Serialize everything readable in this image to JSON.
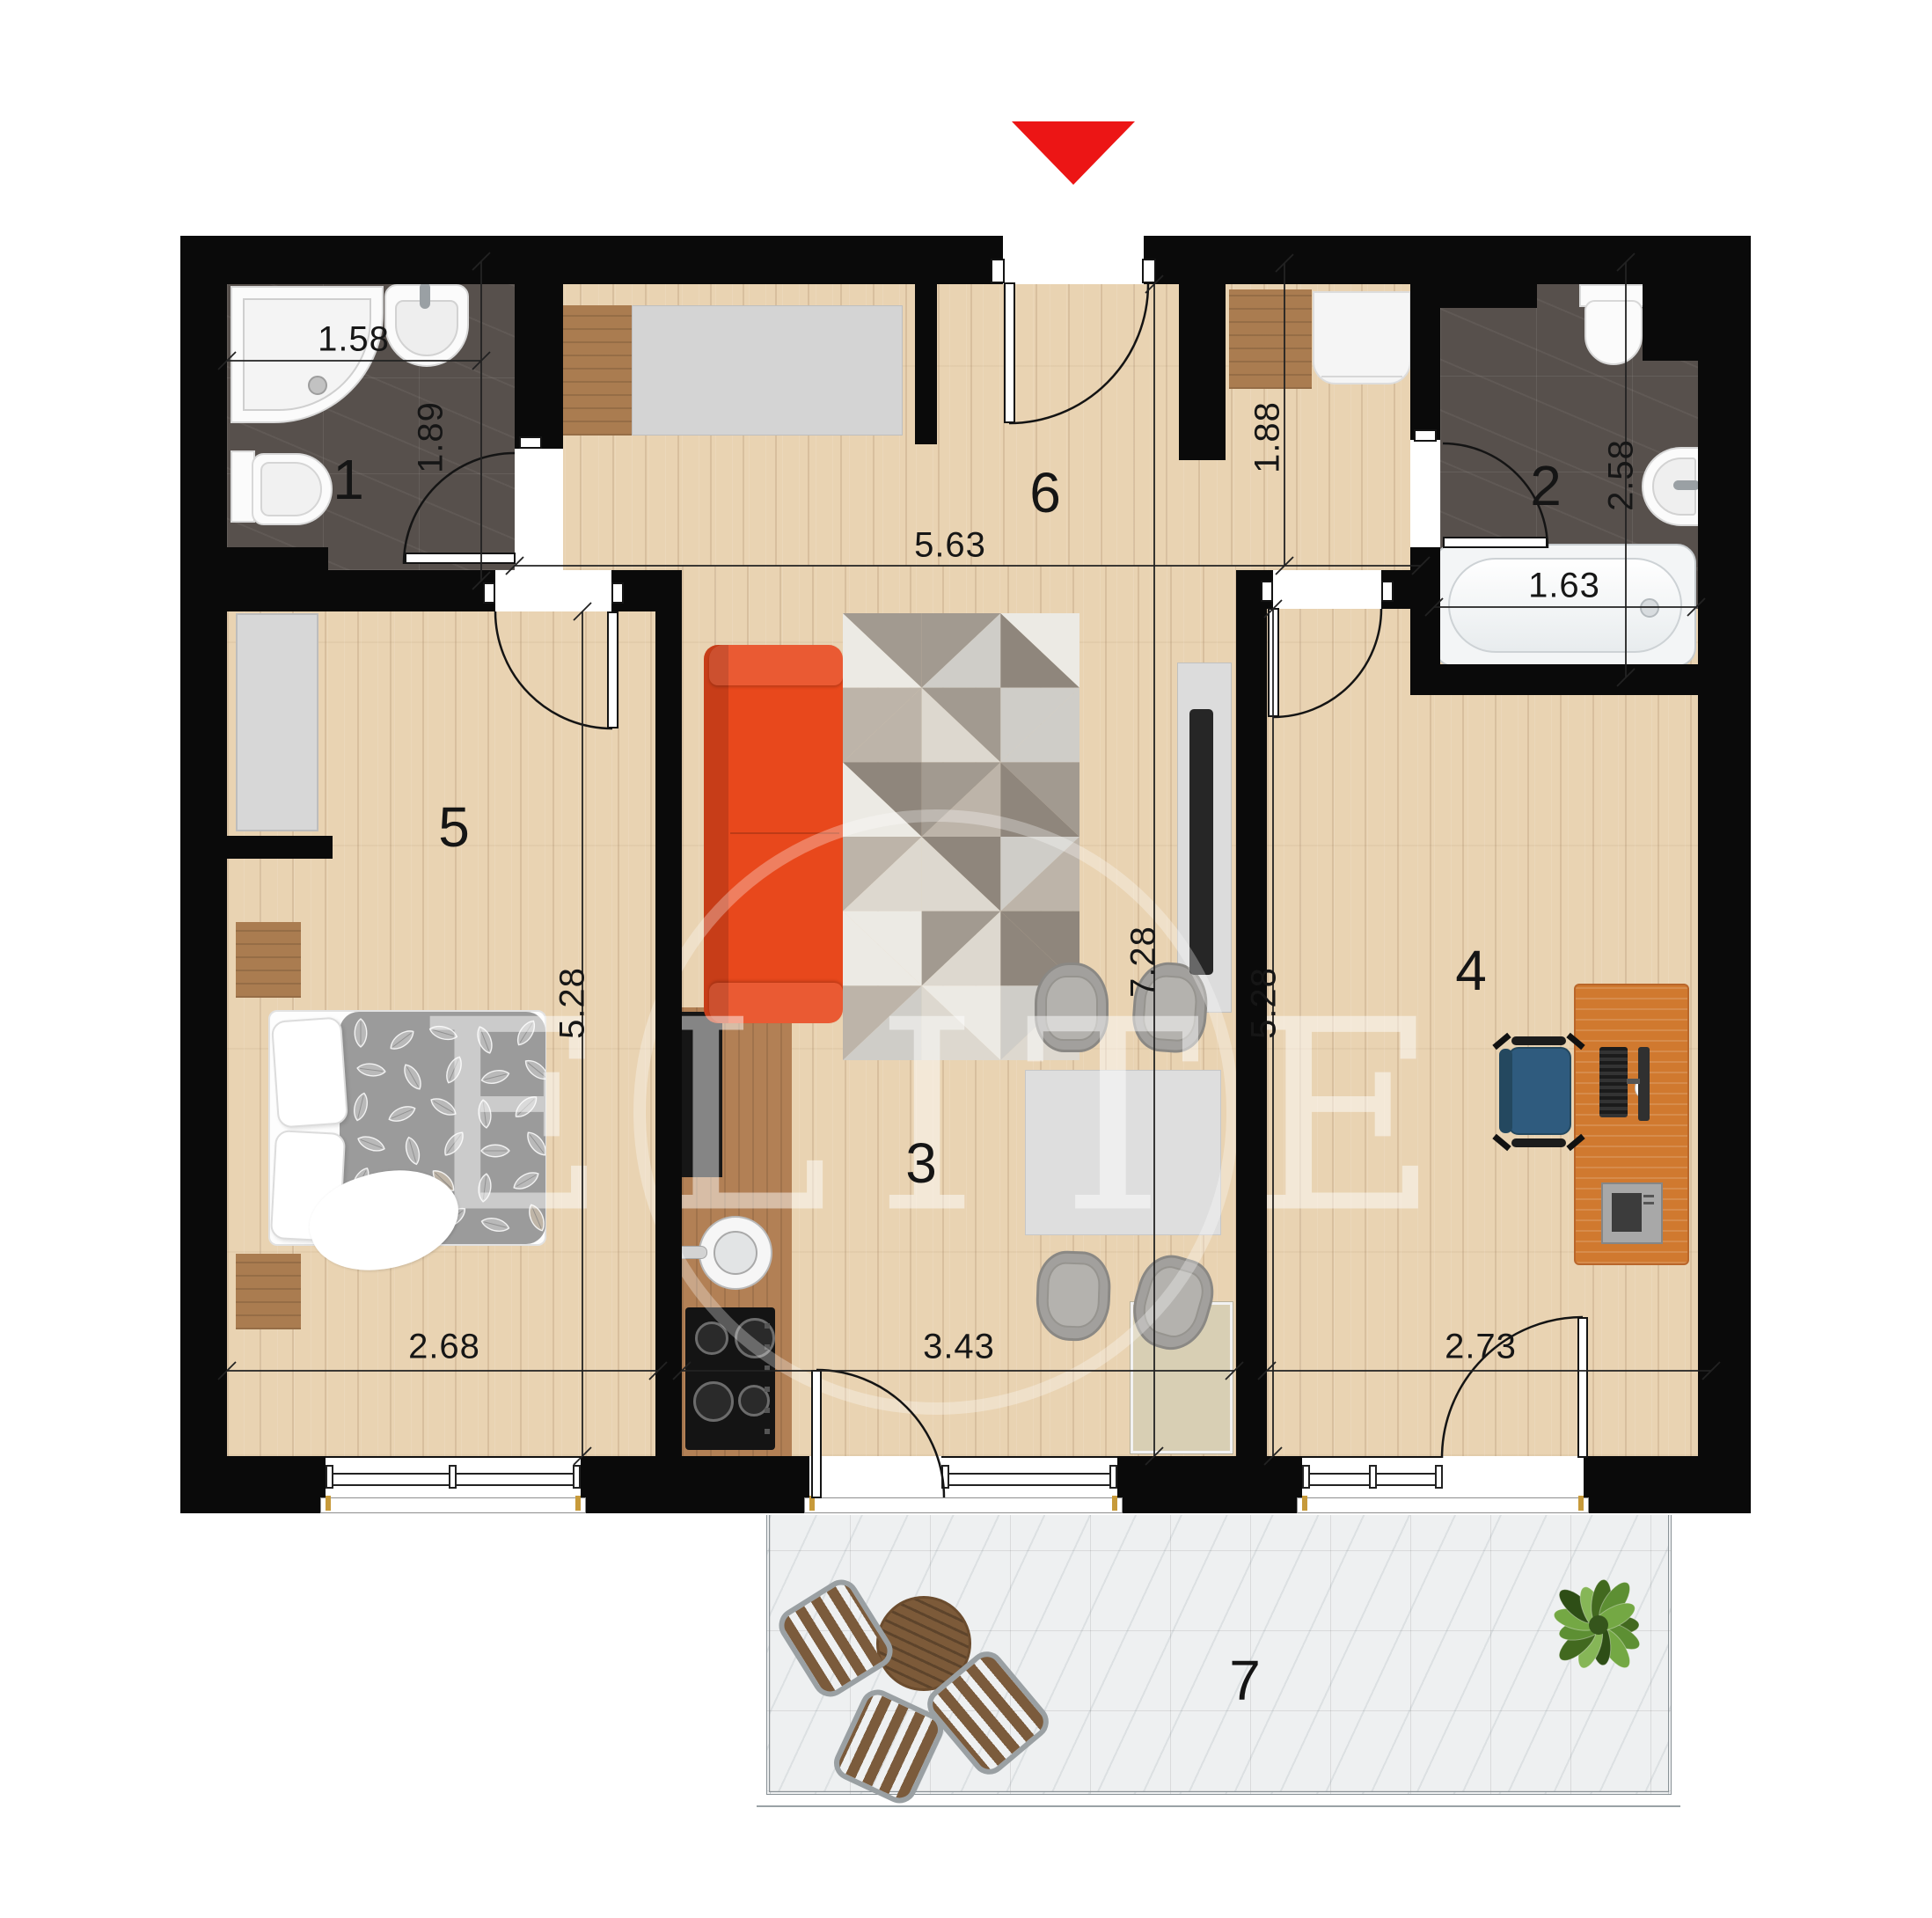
{
  "watermark": "ELITE",
  "rooms": {
    "bath1": "1",
    "bath2": "2",
    "living": "3",
    "office": "4",
    "bedroom": "5",
    "hall": "6",
    "balcony": "7"
  },
  "dims": {
    "bath1_w": "1.58",
    "bath1_d": "1.89",
    "hall_w": "5.63",
    "hall_d": "1.88",
    "bath2_d": "2.58",
    "tub_w": "1.63",
    "total_d": "7.28",
    "bedroom_d": "5.28",
    "office_d": "5.28",
    "bedroom_w": "2.68",
    "living_w": "3.43",
    "office_w": "2.73"
  },
  "colors": {
    "wall": "#0a0a0a",
    "accent_red": "#ec1515",
    "wood": "#e9d3b2",
    "tile_dark": "#57504c",
    "balcony_tile": "#eef0f1",
    "sofa_orange": "#e8481c",
    "desk_orange": "#d0792f",
    "chair_blue": "#2f5b7e",
    "duvet_gray": "#9b9b9b"
  }
}
